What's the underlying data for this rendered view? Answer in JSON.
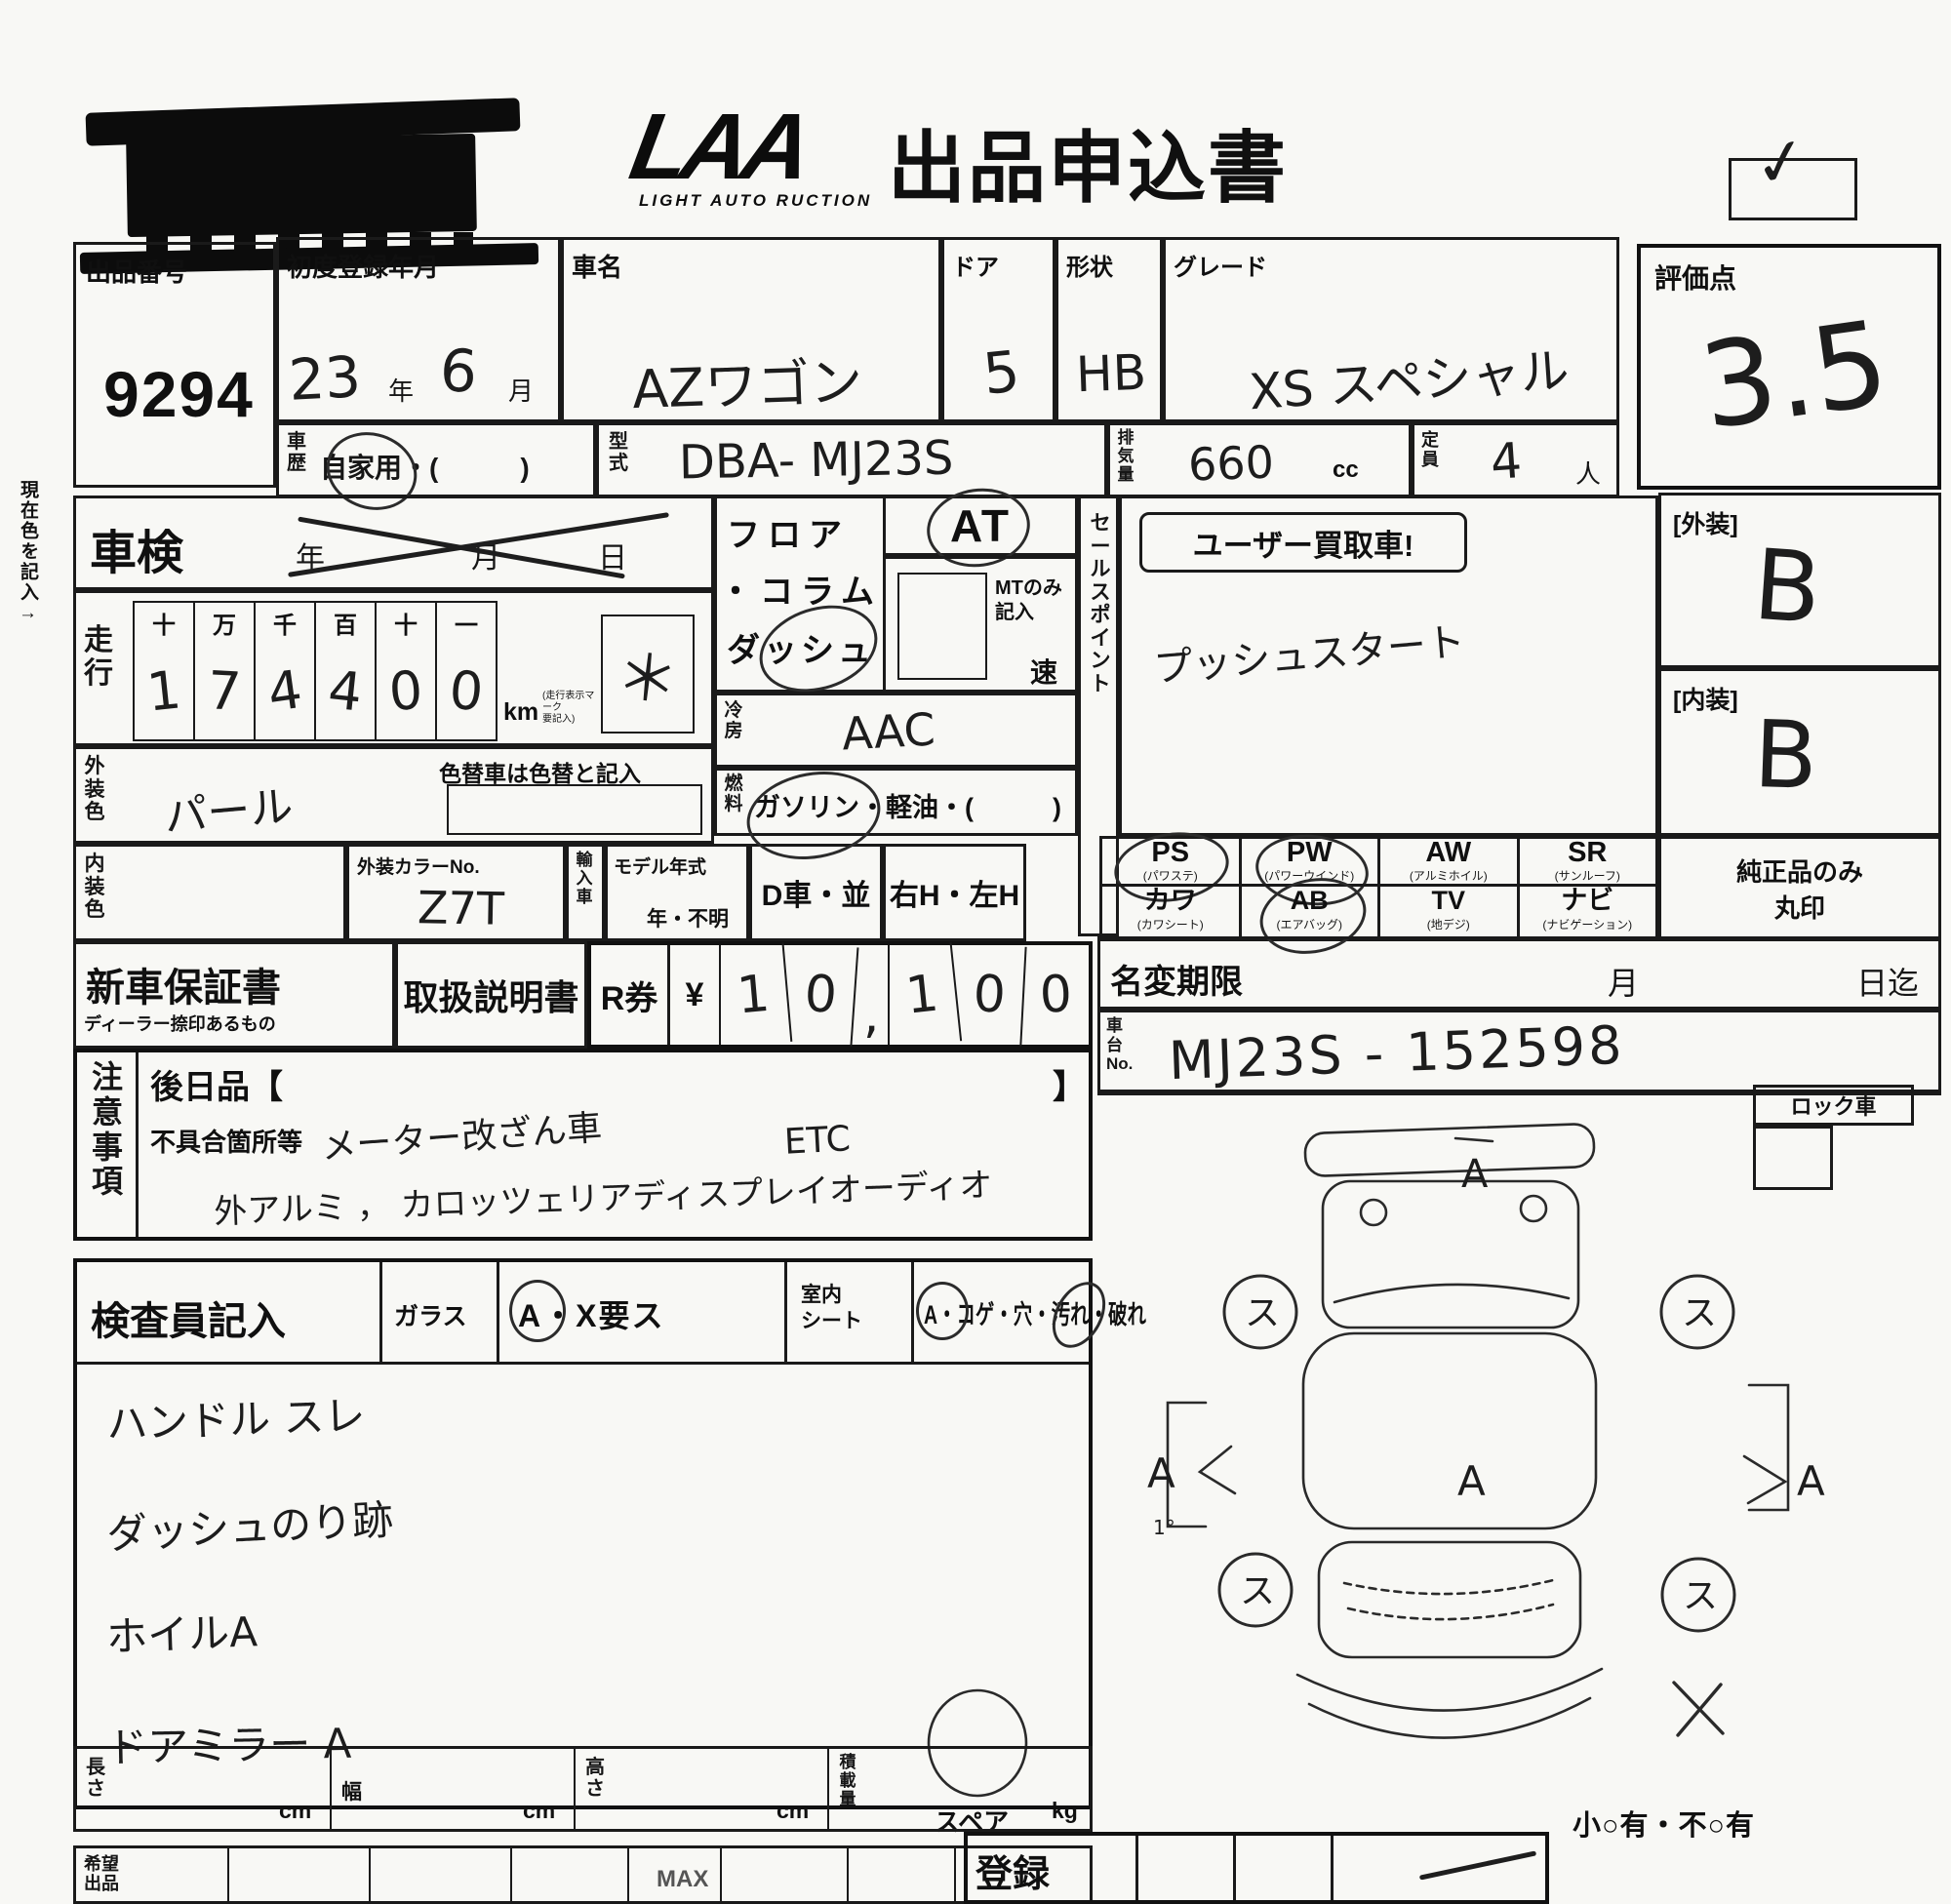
{
  "header": {
    "logo": "LAA",
    "logo_sub": "LIGHT AUTO RUCTION",
    "title": "出品申込書",
    "checkmark": "✓"
  },
  "side_note": "現在色を記入→",
  "lot": {
    "label": "出品番号",
    "value": "9294"
  },
  "first_reg": {
    "label": "初度登録年月",
    "year": "23",
    "year_unit": "年",
    "month": "6",
    "month_unit": "月"
  },
  "car_name": {
    "label": "車名",
    "value": "AZワゴン"
  },
  "door": {
    "label": "ドア",
    "value": "5"
  },
  "shape": {
    "label": "形状",
    "value": "HB"
  },
  "grade": {
    "label": "グレード",
    "value": "XS スペシャル"
  },
  "score": {
    "label": "評価点",
    "value": "3.5"
  },
  "history": {
    "label": "車歴",
    "value": "自家用・(　　　)"
  },
  "model": {
    "label": "型式",
    "value": "DBA- MJ23S"
  },
  "displacement": {
    "label": "排気量",
    "value": "660",
    "unit": "cc"
  },
  "capacity": {
    "label": "定員",
    "value": "4",
    "unit": "人"
  },
  "shaken": {
    "label": "車検",
    "year_unit": "年",
    "month_unit": "月",
    "day_unit": "日"
  },
  "mileage": {
    "label": "走行",
    "headers": [
      "十",
      "万",
      "千",
      "百",
      "十",
      "一"
    ],
    "digits": [
      "1",
      "7",
      "4",
      "4",
      "0",
      "0"
    ],
    "unit": "km",
    "unit_note1": "(走行表示マーク",
    "unit_note2": "要記入)",
    "mark": "＊"
  },
  "body_color": {
    "label": "外装色",
    "value": "パール",
    "repaint_note": "色替車は色替と記入"
  },
  "interior_color": {
    "label": "内装色",
    "value": ""
  },
  "color_no": {
    "label": "外装カラーNo.",
    "value": "Z7T"
  },
  "import_car": {
    "label": "輸入車"
  },
  "model_year": {
    "label": "モデル年式",
    "suffix": "年・不明"
  },
  "dealer": {
    "label": "D車・並"
  },
  "handle": {
    "label": "右H・左H"
  },
  "trans": {
    "line1": "フロア",
    "line2": "・コラム",
    "line3": "ダッシュ",
    "at": "AT",
    "mt_note1": "MTのみ",
    "mt_note2": "記入",
    "speed_unit": "速"
  },
  "ac": {
    "label": "冷房",
    "value": "AAC"
  },
  "fuel": {
    "label": "燃料",
    "value": "ガソリン・軽油・(　　　)"
  },
  "sales_point": {
    "label": "セールスポイント",
    "stamp": "ユーザー買取車!",
    "value": "プッシュスタート"
  },
  "equipment": {
    "items": [
      {
        "code": "PS",
        "sub": "(パワステ)"
      },
      {
        "code": "PW",
        "sub": "(パワーウインド)"
      },
      {
        "code": "AW",
        "sub": "(アルミホイル)"
      },
      {
        "code": "SR",
        "sub": "(サンルーフ)"
      },
      {
        "code": "カワ",
        "sub": "(カワシート)"
      },
      {
        "code": "AB",
        "sub": "(エアバッグ)"
      },
      {
        "code": "TV",
        "sub": "(地デジ)"
      },
      {
        "code": "ナビ",
        "sub": "(ナビゲーション)"
      }
    ],
    "note1": "純正品のみ",
    "note2": "丸印"
  },
  "exterior_grade": {
    "label": "[外装]",
    "value": "B"
  },
  "interior_grade": {
    "label": "[内装]",
    "value": "B"
  },
  "warranty": {
    "label": "新車保証書",
    "sub": "ディーラー捺印あるもの"
  },
  "manual": {
    "label": "取扱説明書"
  },
  "r_ticket": {
    "label": "R券",
    "currency": "¥",
    "digits": [
      "1",
      "0",
      ",",
      "1",
      "0",
      "0"
    ]
  },
  "name_change": {
    "label": "名変期限",
    "month_unit": "月",
    "day_unit": "日迄"
  },
  "chassis": {
    "label1": "車",
    "label2": "台",
    "label3": "No.",
    "value": "MJ23S - 152598"
  },
  "lock": {
    "label": "ロック車"
  },
  "notes_block": {
    "label": "注意事項",
    "later_open": "後日品【",
    "later_close": "】",
    "defects_label": "不具合箇所等",
    "line1": "メーター改ざん車",
    "line1b": "ETC",
    "line2": "外アルミ ， カロッツェリアディスプレイオーディオ"
  },
  "inspector": {
    "label": "検査員記入",
    "glass_label": "ガラス",
    "glass_value": "A・X要ス",
    "seat_label1": "室内",
    "seat_label2": "シート",
    "seat_value": "A・コゲ・穴・汚れ・破れ",
    "notes": [
      "ハンドル スレ",
      "ダッシュのり跡",
      "ホイルA",
      "ドアミラー A"
    ]
  },
  "diagram": {
    "wheel_mark": "ス",
    "mark_top": "A",
    "mark_center": "A",
    "mark_left": "A",
    "mark_right": "A",
    "mark_rear": "X",
    "left_note": "1°",
    "spare_label": "スペア"
  },
  "dimensions": {
    "length_label": "長さ",
    "width_label": "幅",
    "height_label": "高さ",
    "load_label": "積載量",
    "cm": "cm",
    "kg": "kg"
  },
  "bottom": {
    "wish_label": "希望出品",
    "max": "MAX",
    "reg_label": "登録",
    "flaw_note": "小○有・不○有"
  }
}
